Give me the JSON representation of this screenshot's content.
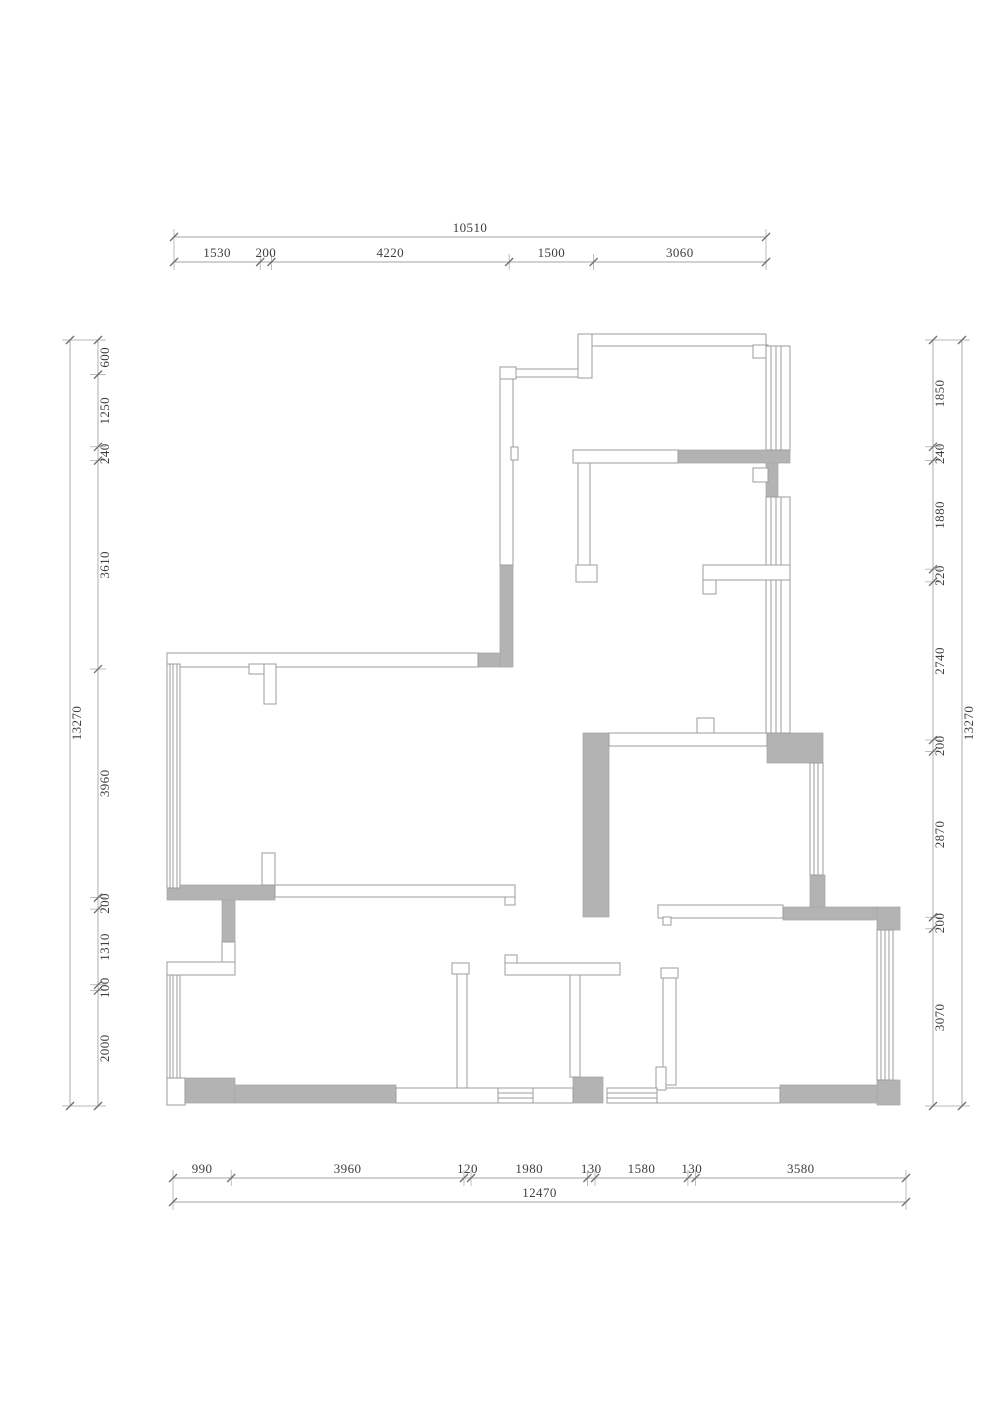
{
  "drawing": {
    "type": "architectural floor plan",
    "units": "mm",
    "colors": {
      "wall_hatch": "#b3b3b3",
      "line": "#9c9c9c",
      "dimension_text": "#3e3e3e"
    }
  },
  "dimensions": {
    "top": {
      "total": "10510",
      "segments": [
        "1530",
        "200",
        "4220",
        "1500",
        "3060"
      ]
    },
    "bottom": {
      "total": "12470",
      "segments": [
        "990",
        "3960",
        "120",
        "1980",
        "130",
        "1580",
        "130",
        "3580"
      ]
    },
    "left": {
      "total": "13270",
      "segments": [
        "600",
        "1250",
        "240",
        "3610",
        "3960",
        "200",
        "1310",
        "100",
        "2000"
      ]
    },
    "right": {
      "total": "13270",
      "segments": [
        "1850",
        "240",
        "1880",
        "220",
        "2740",
        "200",
        "2870",
        "200",
        "3070"
      ]
    }
  }
}
